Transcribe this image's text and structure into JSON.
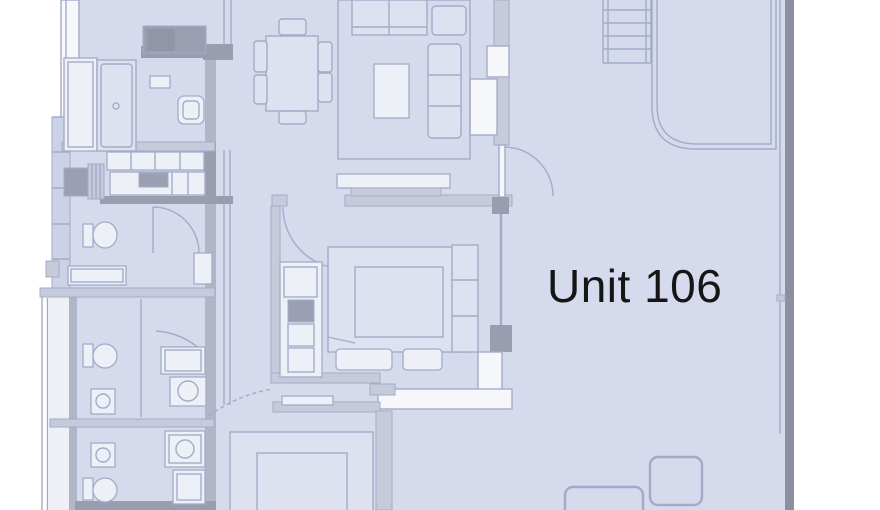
{
  "page": {
    "background": "#ffffff"
  },
  "floorplan": {
    "unit_label": "Unit 106",
    "colors": {
      "page_bg": "#ffffff",
      "plan_fill": "#d5daed",
      "wall_light": "#a3abc8",
      "wall_medium": "#c6cbdc",
      "wall_dark": "#989db0",
      "wall_darkest": "#8b90a0",
      "wall_spine": "#b0b6c8",
      "fixture_fill": "#eef0f7",
      "furniture_fill": "#dde1f0",
      "dark_block": "#9aa0b2",
      "window_fill": "#ccd2e5",
      "walkway_fill": "#eef0f6",
      "label_color": "#161616"
    }
  }
}
